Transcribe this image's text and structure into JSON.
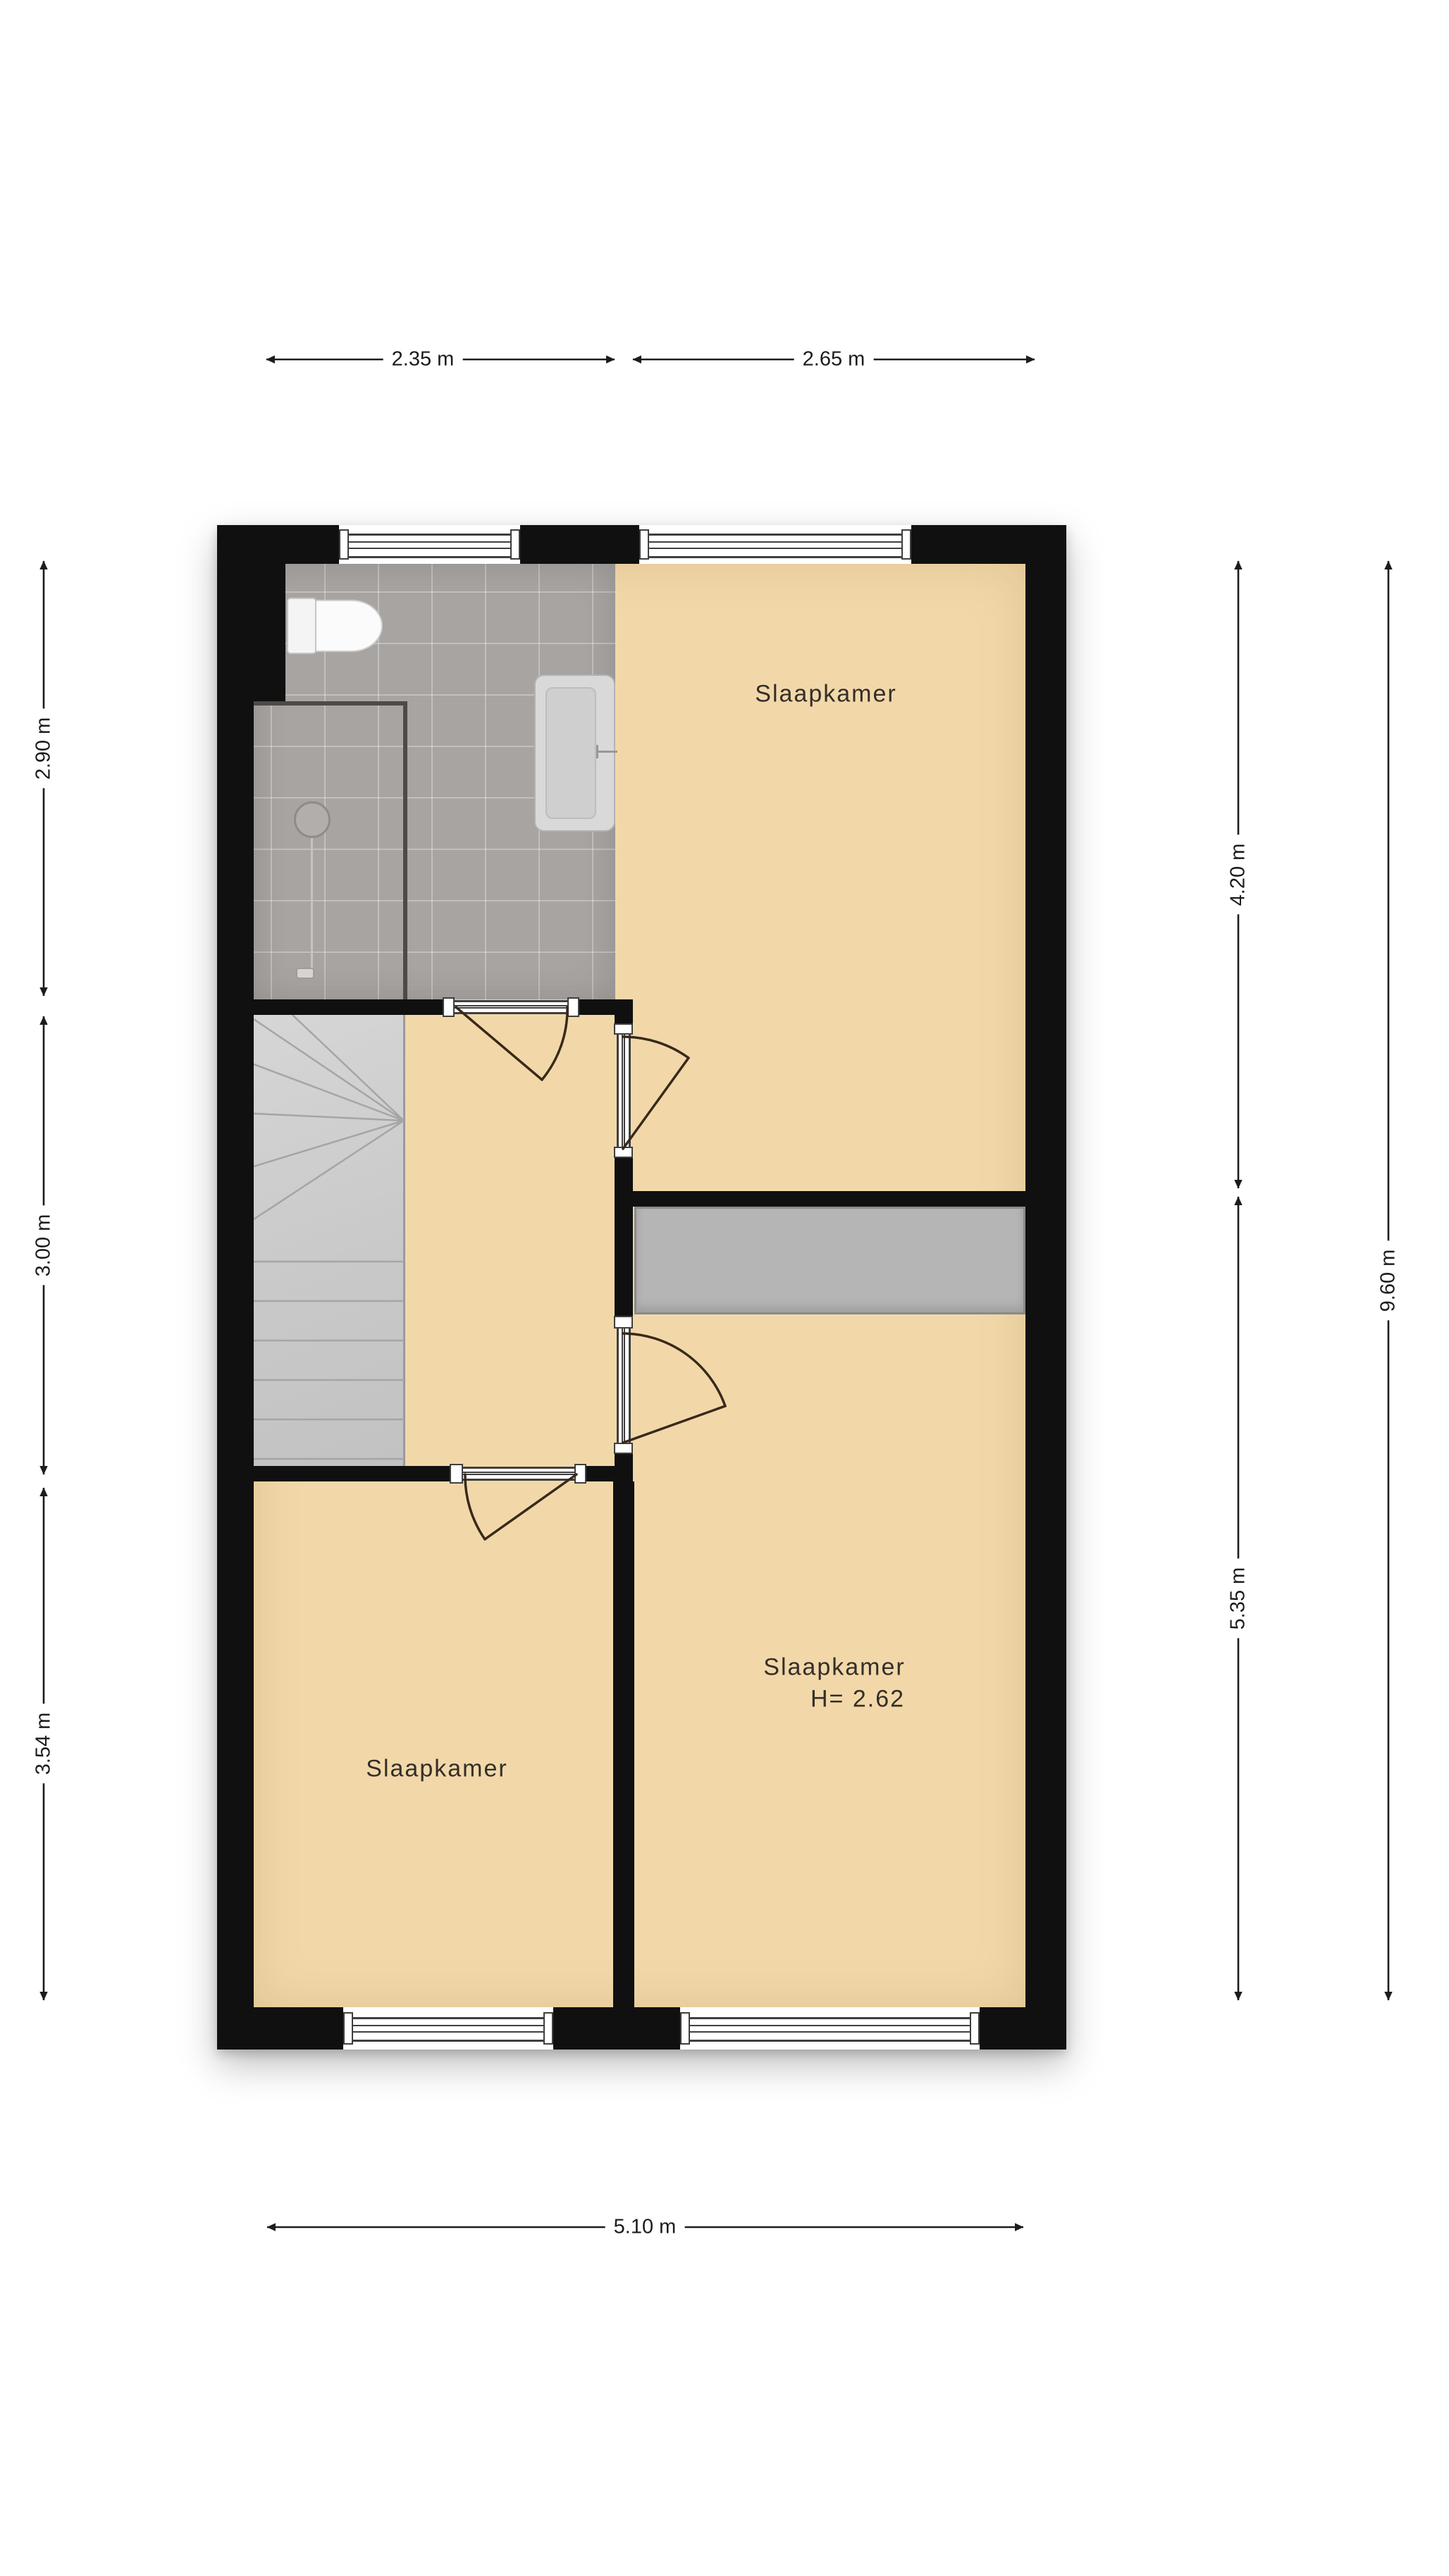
{
  "floorplan": {
    "type": "floor-plan",
    "language": "nl",
    "rooms": [
      {
        "id": "bedroom-top-right",
        "label": "Slaapkamer"
      },
      {
        "id": "bedroom-bottom-left",
        "label": "Slaapkamer"
      },
      {
        "id": "bedroom-bottom-right",
        "label": "Slaapkamer",
        "height_label": "H= 2.62"
      },
      {
        "id": "bathroom",
        "label": ""
      },
      {
        "id": "hall",
        "label": ""
      },
      {
        "id": "stairs",
        "label": ""
      }
    ],
    "fixtures": [
      {
        "name": "toilet"
      },
      {
        "name": "sink"
      },
      {
        "name": "shower"
      }
    ],
    "dimensions": {
      "top": [
        {
          "label": "2.35 m"
        },
        {
          "label": "2.65 m"
        }
      ],
      "bottom": [
        {
          "label": "5.10 m"
        }
      ],
      "left": [
        {
          "label": "2.90 m"
        },
        {
          "label": "3.00 m"
        },
        {
          "label": "3.54 m"
        }
      ],
      "right": [
        {
          "label": "4.20 m"
        },
        {
          "label": "5.35 m"
        },
        {
          "label": "9.60 m"
        }
      ]
    },
    "colors": {
      "wall": "#101010",
      "floor": "#f2d8a9",
      "tile": "#a8a4a1",
      "stairs": "#cdcdcd",
      "void": "#b5b5b5",
      "door": "#38291a",
      "frame": "#3f3f3f",
      "dim": "#1c1c1c",
      "label": "#332e28",
      "fixture": "#d9d9d9"
    }
  }
}
